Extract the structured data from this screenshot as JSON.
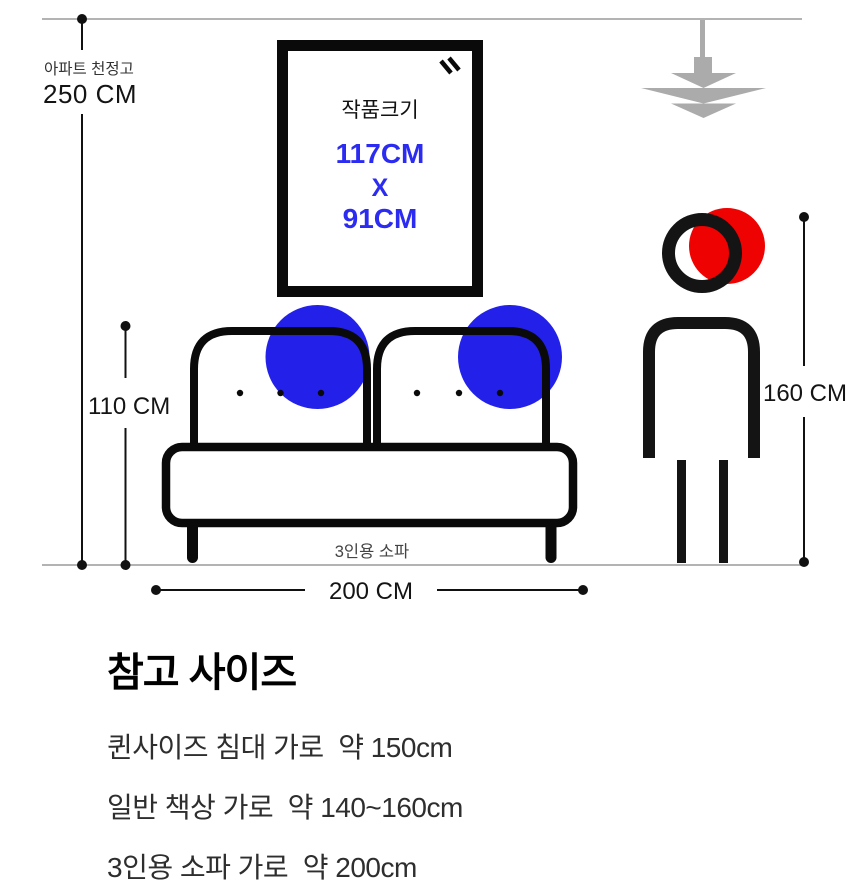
{
  "diagram": {
    "ceiling": {
      "label": "아파트 천정고",
      "height_label": "250 CM"
    },
    "artwork": {
      "title": "작품크기",
      "width_label": "117CM",
      "times_label": "X",
      "height_label": "91CM"
    },
    "sofa": {
      "label": "3인용 소파",
      "height_label": "110 CM",
      "width_label": "200 CM"
    },
    "person": {
      "height_label": "160 CM"
    },
    "colors": {
      "accent_blue_text": "#2B2BF2",
      "accent_blue_circle": "#2321E9",
      "accent_red": "#EE0202",
      "lamp_gray": "#ABABAB",
      "guide_line_gray": "#B3B3B3",
      "ink": "#111111"
    }
  },
  "reference": {
    "heading": "참고 사이즈",
    "items": [
      {
        "text": "퀸사이즈 침대 가로  약 150cm"
      },
      {
        "text": "일반 책상 가로  약 140~160cm"
      },
      {
        "text": "3인용 소파 가로  약 200cm"
      }
    ]
  }
}
